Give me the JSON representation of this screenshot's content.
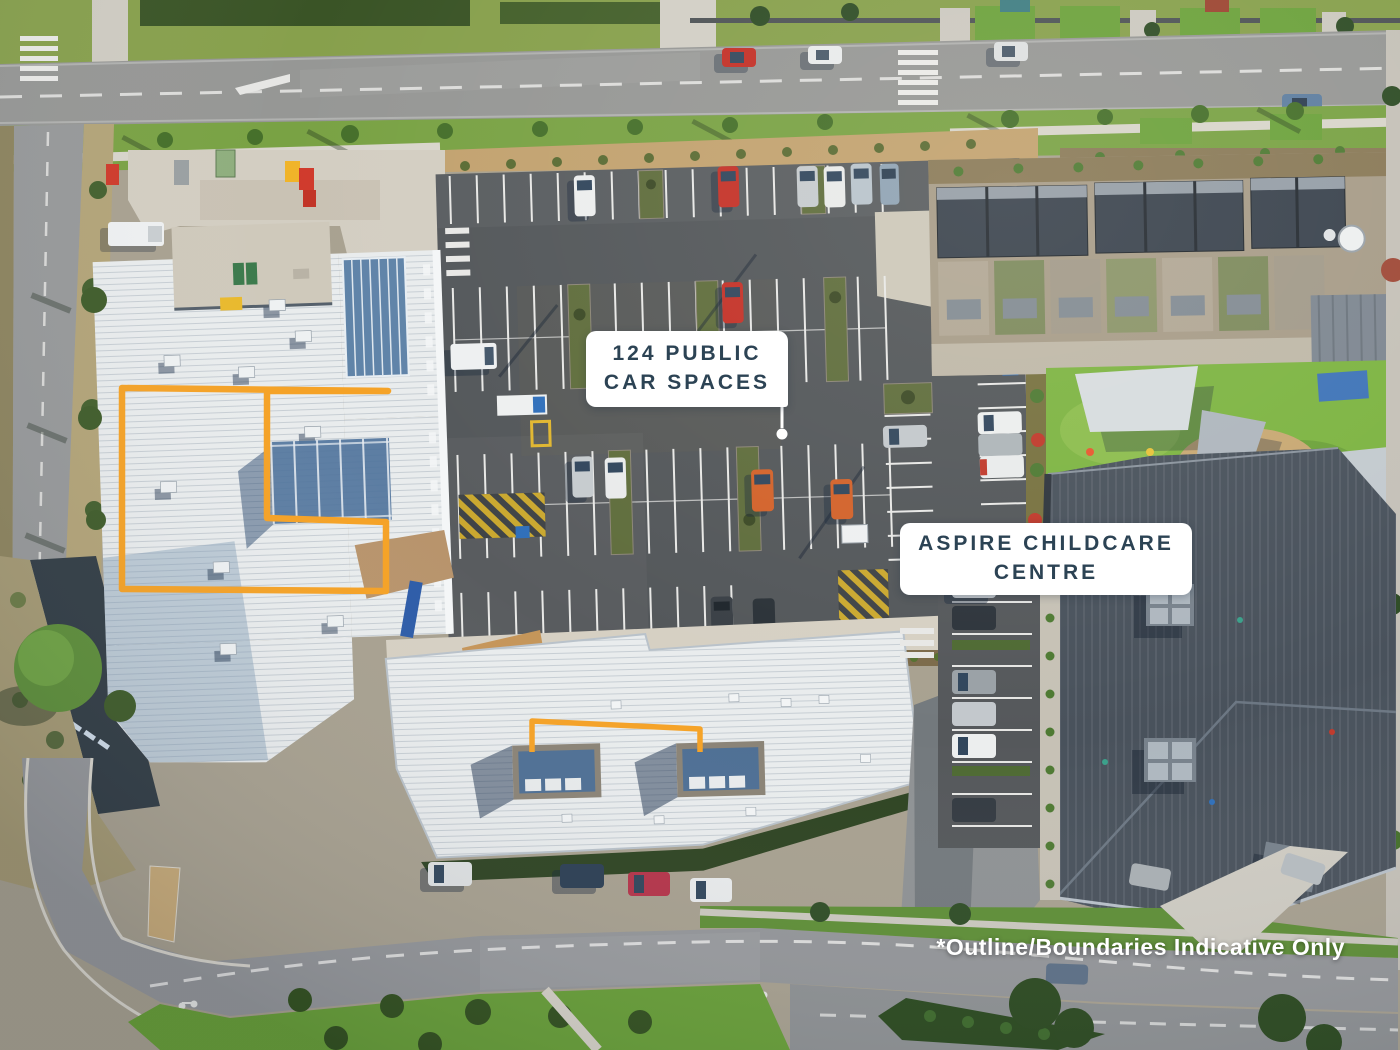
{
  "annotations": {
    "car_spaces_label": {
      "line1": "124 PUBLIC",
      "line2": "CAR SPACES"
    },
    "childcare_label": {
      "line1": "ASPIRE CHILDCARE",
      "line2": "CENTRE"
    },
    "disclaimer": "*Outline/Boundaries Indicative Only"
  },
  "colors": {
    "boundary_orange": "#F5A226",
    "label_background": "#FFFFFF",
    "label_text": "#2C4354",
    "disclaimer_text": "#FFFFFF"
  }
}
